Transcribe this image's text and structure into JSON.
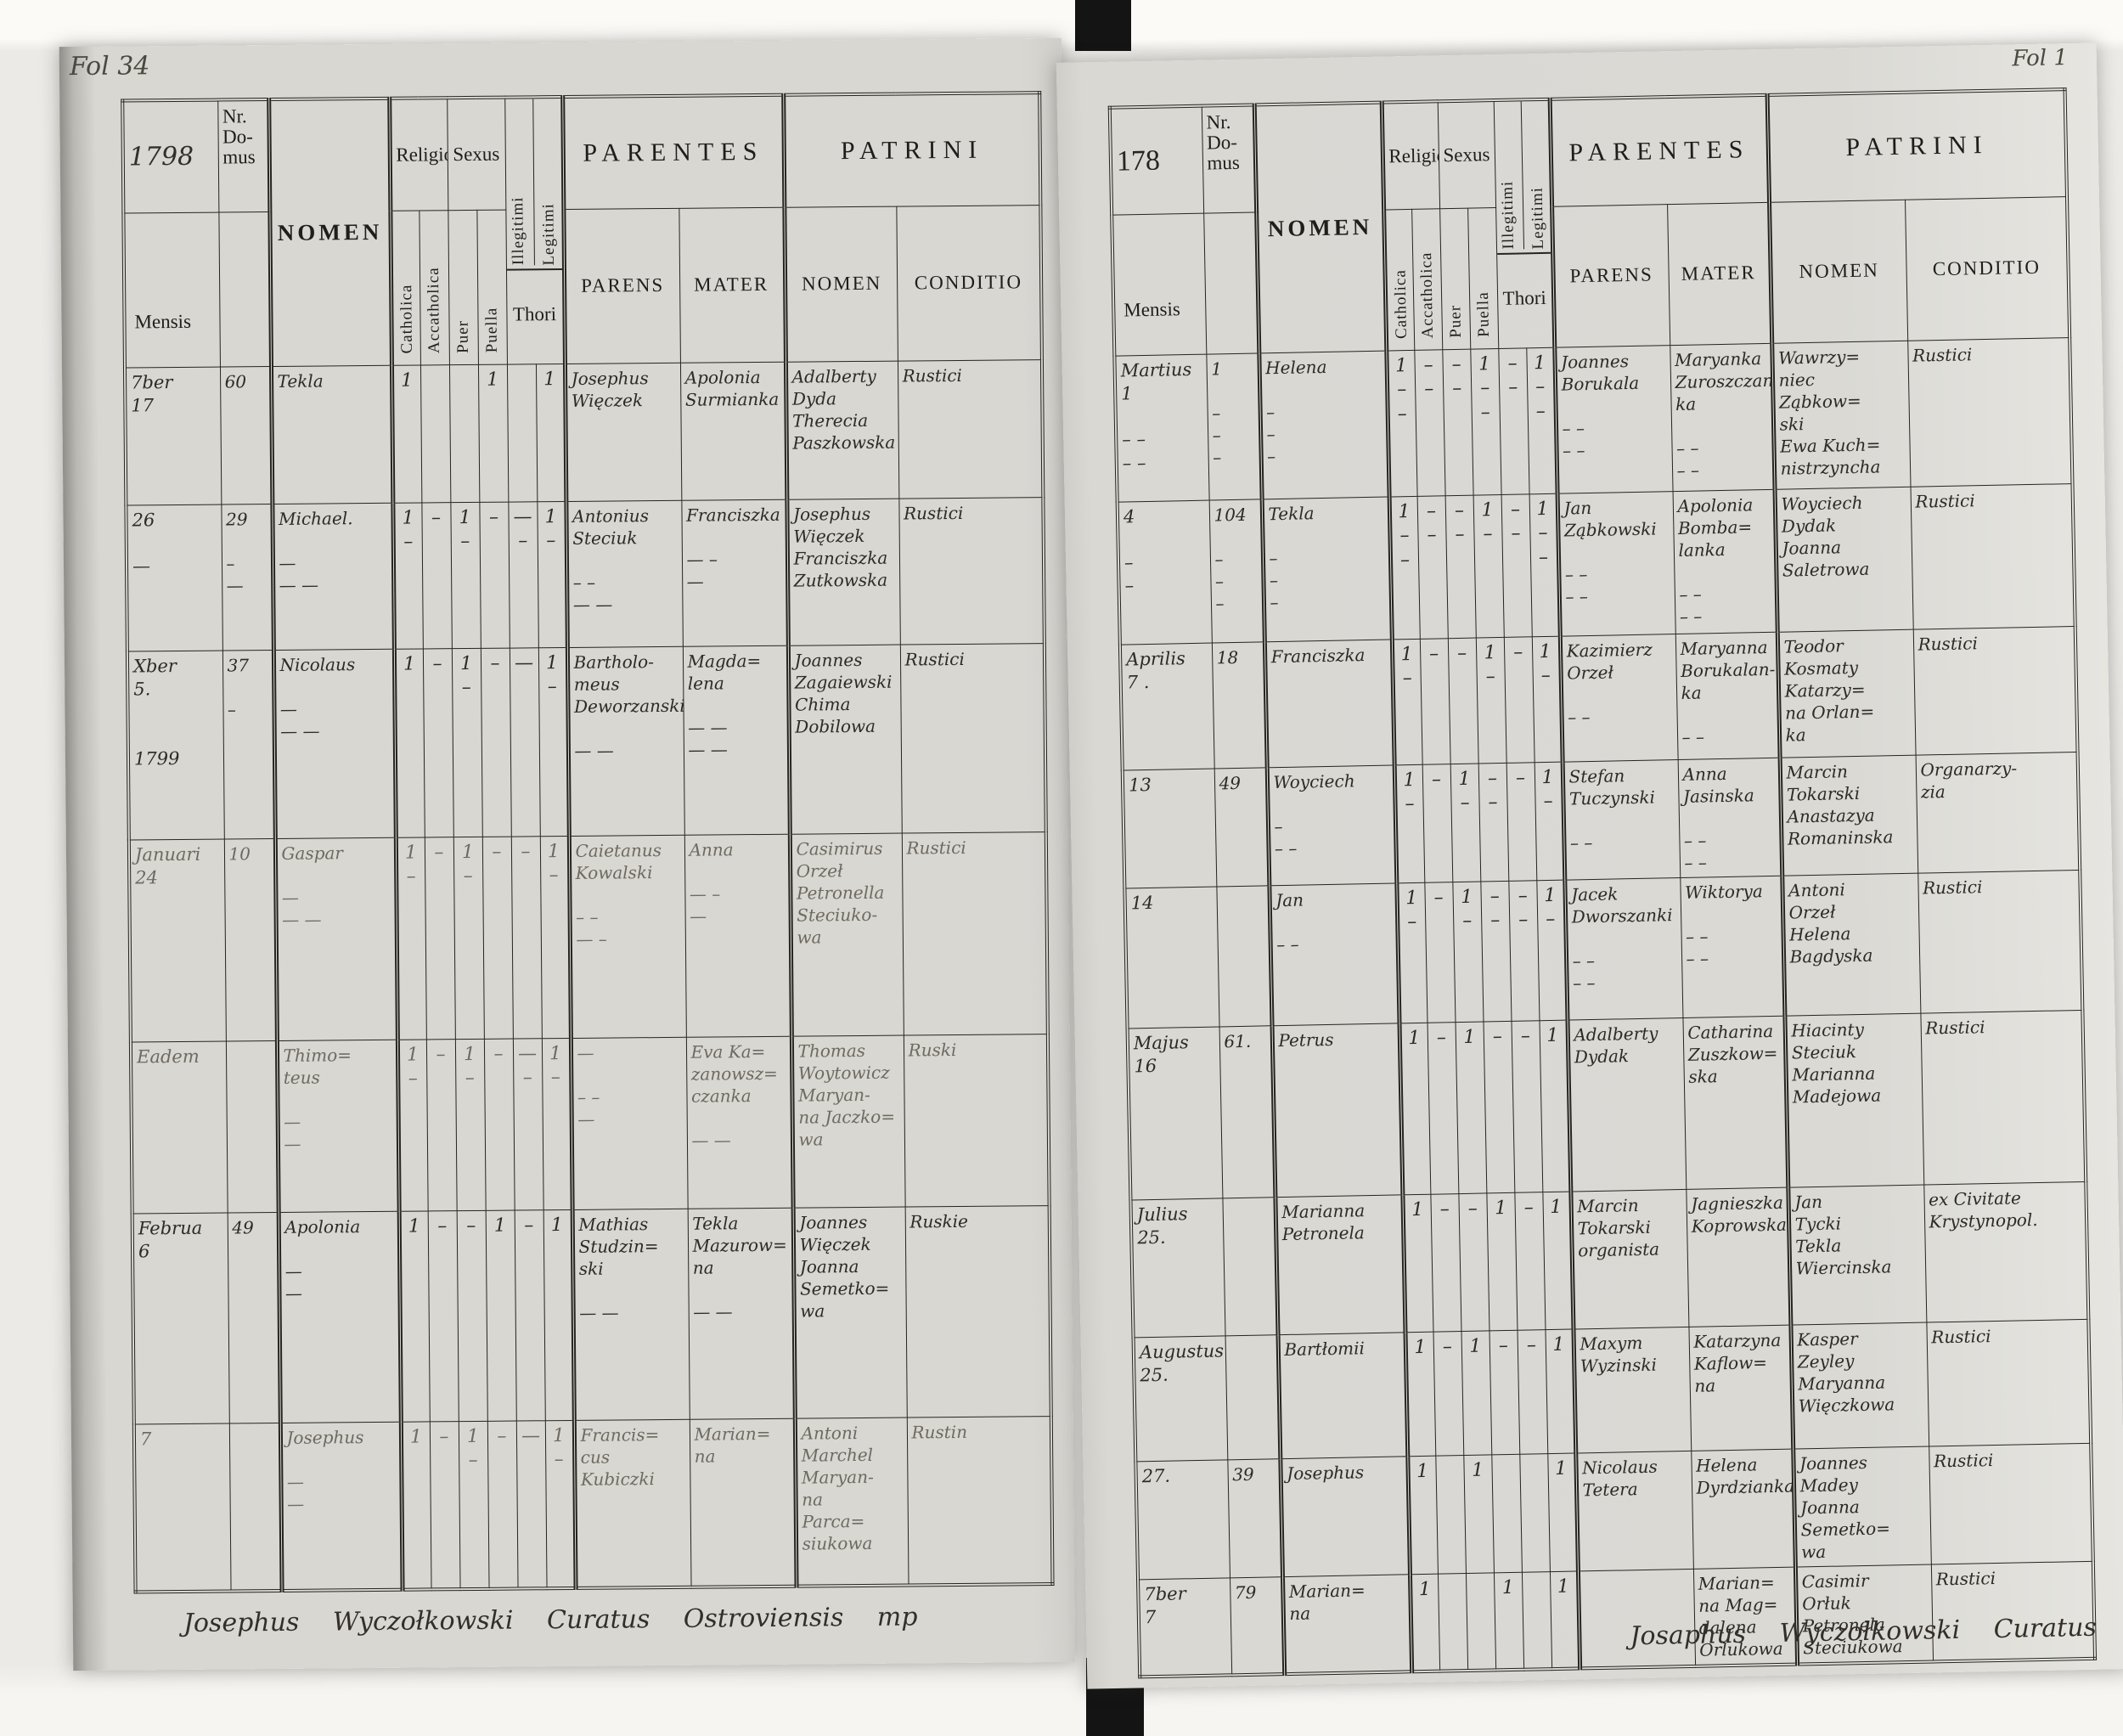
{
  "form_labels": {
    "nr_domus": "Nr.\nDo-\nmus",
    "mensis": "Mensis",
    "nomen": "NOMEN",
    "religio": "Religio",
    "sexus": "Sexus",
    "catholica": "Catholica",
    "accatholica": "Accatholica",
    "puer": "Puer",
    "puella": "Puella",
    "illegitimi": "Illegitimi",
    "legitimi": "Legitimi",
    "thori": "Thori",
    "parentes": "PARENTES",
    "patrini": "PATRINI",
    "parens": "PARENS",
    "mater": "MATER",
    "patrini_nomen": "NOMEN",
    "conditio": "CONDITIO"
  },
  "page_left": {
    "folio": "Fol 34",
    "year": "1798",
    "signature": "Josephus Wyczołkowski Curatus Ostroviensis mp",
    "rows": [
      {
        "mensis": "7ber\n17",
        "nr": "60",
        "nomen": "Tekla",
        "t": [
          "1",
          "",
          "",
          "1",
          "",
          "1"
        ],
        "parens": "Josephus\nWięczek",
        "mater": "Apolonia\nSurmianka",
        "patrini": "Adalberty\nDyda\nTherecia\nPaszkowska",
        "conditio": "Rustici"
      },
      {
        "mensis": "26\n\n—",
        "nr": "29\n\n–\n—",
        "nomen": "Michael.\n\n—\n— —",
        "t": [
          "1\n–",
          "–",
          "1\n–",
          "–",
          "— –",
          "1\n–"
        ],
        "parens": "Antonius\nSteciuk\n\n– –\n— —",
        "mater": "Franciszka\n\n— –\n—",
        "patrini": "Josephus\nWięczek\nFranciszka\nZutkowska",
        "conditio": "Rustici"
      },
      {
        "mensis": "Xber\n5.\n\n\n1799",
        "nr": "37\n\n–",
        "nomen": "Nicolaus\n\n—\n— —",
        "t": [
          "1",
          "–",
          "1\n–",
          "–",
          "—",
          "1\n–"
        ],
        "parens": "Bartholo-\nmeus\nDeworzanski\n\n— —",
        "mater": "Magda=\nlena\n\n— —\n— —",
        "patrini": "Joannes\nZagaiewski\nChima\nDobilowa",
        "conditio": "Rustici"
      },
      {
        "mensis": "Januari\n24",
        "nr": "10",
        "nomen": "Gaspar\n\n—\n— —",
        "faint": true,
        "t": [
          "1\n–",
          "–",
          "1\n–",
          "–",
          "–",
          "1\n–"
        ],
        "parens": "Caietanus\nKowalski\n\n– –\n— –",
        "mater": "Anna\n\n— –\n—",
        "patrini": "Casimirus\nOrzeł\nPetronella\nSteciuko-\nwa",
        "conditio": "Rustici"
      },
      {
        "mensis": "Eadem",
        "nr": "",
        "nomen": "Thimo=\nteus\n\n—\n—",
        "faint": true,
        "t": [
          "1\n–",
          "–",
          "1\n–",
          "–",
          "— –",
          "1\n–"
        ],
        "parens": "—\n\n– –\n—",
        "mater": "Eva Ka=\nzanowsz=\nczanka\n\n— —",
        "patrini": "Thomas\nWoytowicz\nMaryan-\nna Jaczko=\nwa",
        "conditio": "Ruski"
      },
      {
        "mensis": "Februa\n6",
        "nr": "49",
        "nomen": "Apolonia\n\n—\n—",
        "t": [
          "1",
          "–",
          "–",
          "1",
          "–",
          "1"
        ],
        "parens": "Mathias\nStudzin=\nski\n\n— —",
        "mater": "Tekla\nMazurow=\nna\n\n— —",
        "patrini": "Joannes\nWięczek\nJoanna\nSemetko=\nwa",
        "conditio": "Ruskie"
      },
      {
        "mensis": "7",
        "nr": "",
        "nomen": "Josephus\n\n—\n—",
        "faint": true,
        "t": [
          "1",
          "–",
          "1\n–",
          "–",
          "—",
          "1\n–"
        ],
        "parens": "Francis=\ncus\nKubiczki",
        "mater": "Marian=\nna",
        "patrini": "Antoni\nMarchel\nMaryan-\nna\nParca=\nsiukowa",
        "conditio": "Rustin"
      }
    ]
  },
  "page_right": {
    "folio": "Fol 1",
    "year": "178",
    "signature": "Josaphus Wyczołkowski Curatus Ostroviensis",
    "rows": [
      {
        "mensis": "Martius\n1\n\n–  –\n–  –",
        "nr": "1\n\n–\n–\n–",
        "nomen": "Helena\n\n–\n–\n–",
        "t": [
          "1\n–\n–",
          "–\n–",
          "–\n–",
          "1\n–\n–",
          "–\n–",
          "1\n–\n–"
        ],
        "parens": "Joannes\nBorukala\n\n– –\n– –",
        "mater": "Maryanka\nZuroszczan-\nka\n\n– –\n– –",
        "patrini": "Wawrzy=\nniec\nZąbkow=\nski\nEwa Kuch=\nnistrzyncha",
        "conditio": "Rustici"
      },
      {
        "mensis": "4\n\n–\n–",
        "nr": "104\n\n–\n–\n–",
        "nomen": "Tekla\n\n–\n–\n–",
        "t": [
          "1\n–\n–",
          "–\n–",
          "–\n–",
          "1\n–",
          "–\n–",
          "1\n–\n–"
        ],
        "parens": "Jan\nZąbkowski\n\n– –\n– –",
        "mater": "Apolonia\nBomba=\nlanka\n\n– –\n– –",
        "patrini": "Woyciech\nDydak\nJoanna\nSaletrowa",
        "conditio": "Rustici"
      },
      {
        "mensis": "Aprilis\n7 .",
        "nr": "18",
        "nomen": "Franciszka",
        "t": [
          "1\n–",
          "–",
          "–",
          "1\n–",
          "–",
          "1\n–"
        ],
        "parens": "Kazimierz\nOrzeł\n\n– –",
        "mater": "Maryanna\nBorukalan-\nka\n\n– –",
        "patrini": "Teodor\nKosmaty\nKatarzy=\nna Orlan=\nka",
        "conditio": "Rustici"
      },
      {
        "mensis": "13",
        "nr": "49",
        "nomen": "Woyciech\n\n–\n– –",
        "t": [
          "1\n–",
          "–",
          "1\n–",
          "–\n–",
          "–",
          "1\n–"
        ],
        "parens": "Stefan\nTuczynski\n\n– –",
        "mater": "Anna\nJasinska\n\n– –\n– –",
        "patrini": "Marcin\nTokarski\nAnastazya\nRomaninska",
        "conditio": "Organarzy-\nzia"
      },
      {
        "mensis": "14",
        "nr": "",
        "nomen": "Jan\n\n– –",
        "t": [
          "1\n–",
          "–",
          "1\n–",
          "–\n–",
          "–\n–",
          "1\n–"
        ],
        "parens": "Jacek\nDworszanki\n\n– –\n– –",
        "mater": "Wiktorya\n\n– –\n– –",
        "patrini": "Antoni\nOrzeł\nHelena\nBagdyska",
        "conditio": "Rustici"
      },
      {
        "mensis": "Majus\n16",
        "nr": "61.",
        "nomen": "Petrus",
        "t": [
          "1",
          "–",
          "1",
          "–",
          "–",
          "1"
        ],
        "parens": "Adalberty\nDydak",
        "mater": "Catharina\nZuszkow=\nska",
        "patrini": "Hiacinty\nSteciuk\nMarianna\nMadejowa",
        "conditio": "Rustici"
      },
      {
        "mensis": "Julius\n25.",
        "nr": "",
        "nomen": "Marianna\nPetronela",
        "t": [
          "1",
          "–",
          "–",
          "1",
          "–",
          "1"
        ],
        "parens": "Marcin\nTokarski\norganista",
        "mater": "Jagnieszka\nKoprowska",
        "patrini": "Jan\nTycki\nTekla\nWiercinska",
        "conditio": "ex Civitate\nKrystynopol."
      },
      {
        "mensis": "Augustus\n25.",
        "nr": "",
        "nomen": "Bartłomii",
        "t": [
          "1",
          "–",
          "1",
          "–",
          "–",
          "1"
        ],
        "parens": "Maxym\nWyzinski",
        "mater": "Katarzyna\nKaflow=\nna",
        "patrini": "Kasper\nZeyley\nMaryanna\nWięczkowa",
        "conditio": "Rustici"
      },
      {
        "mensis": "27.",
        "nr": "39",
        "nomen": "Josephus",
        "t": [
          "1",
          "",
          "1",
          "",
          "",
          "1"
        ],
        "parens": "Nicolaus\nTetera",
        "mater": "Helena\nDyrdzianka",
        "patrini": "Joannes\nMadey\nJoanna\nSemetko=\nwa",
        "conditio": "Rustici"
      },
      {
        "mensis": "7ber\n7",
        "nr": "79",
        "nomen": "Marian=\nna",
        "t": [
          "1",
          "",
          "",
          "1",
          "",
          "1"
        ],
        "parens": "",
        "mater": "Marian=\nna Mag=\ndalena\nOrlukowa",
        "patrini": "Casimir\nOrłuk\nPetronela\nSteciukowa",
        "conditio": "Rustici"
      }
    ]
  }
}
